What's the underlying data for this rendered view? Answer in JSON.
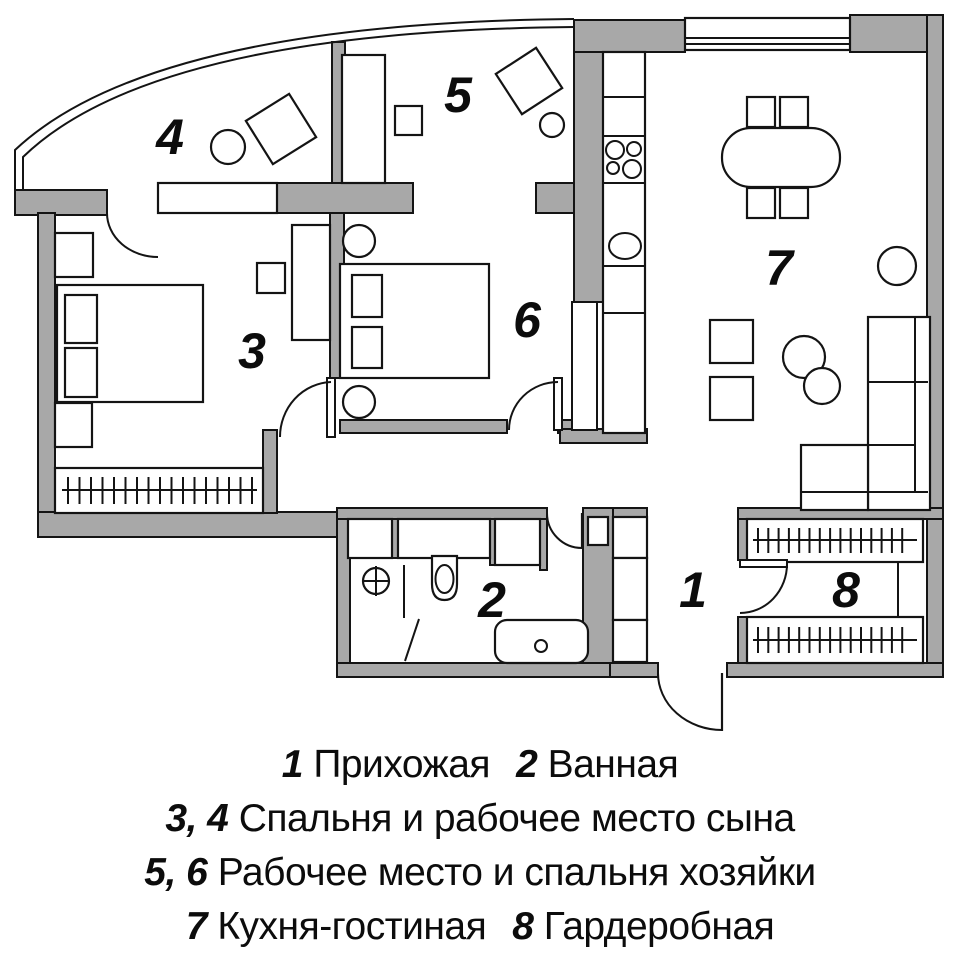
{
  "colors": {
    "wall": "#a8a8a8",
    "outline": "#141414",
    "background": "#ffffff"
  },
  "plan": {
    "rooms": [
      {
        "n": "1"
      },
      {
        "n": "2"
      },
      {
        "n": "3"
      },
      {
        "n": "4"
      },
      {
        "n": "5"
      },
      {
        "n": "6"
      },
      {
        "n": "7"
      },
      {
        "n": "8"
      }
    ]
  },
  "legend": {
    "lines": [
      {
        "segments": [
          {
            "num": "1",
            "name": "Прихожая"
          },
          {
            "num": "2",
            "name": "Ванная"
          }
        ]
      },
      {
        "segments": [
          {
            "num": "3, 4",
            "name": "Спальня и рабочее место сына"
          }
        ]
      },
      {
        "segments": [
          {
            "num": "5, 6",
            "name": "Рабочее место и спальня хозяйки"
          }
        ]
      },
      {
        "segments": [
          {
            "num": "7",
            "name": "Кухня-гостиная"
          },
          {
            "num": "8",
            "name": "Гардеробная"
          }
        ]
      }
    ]
  }
}
